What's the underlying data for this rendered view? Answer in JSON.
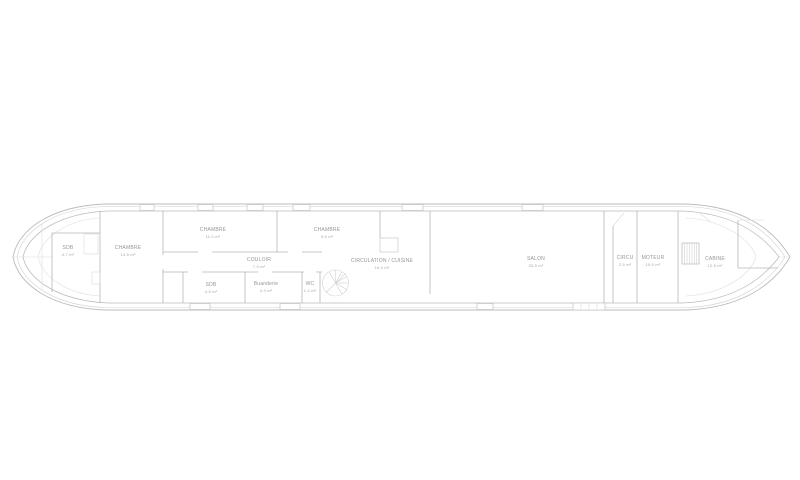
{
  "plan": {
    "title": "Barge floor plan",
    "background": "#ffffff",
    "line_color": "#b4b7ba",
    "light_line_color": "#d7d9da",
    "text_color": "#93969a"
  },
  "rooms": [
    {
      "id": "sdb-bow",
      "name": "SDB",
      "area": "4.7 m²"
    },
    {
      "id": "chambre-1",
      "name": "CHAMBRE",
      "area": "13.5 m²"
    },
    {
      "id": "chambre-2",
      "name": "CHAMBRE",
      "area": "11.0 m²"
    },
    {
      "id": "chambre-3",
      "name": "CHAMBRE",
      "area": "9.5 m²"
    },
    {
      "id": "couloir",
      "name": "COULOIR",
      "area": "7.5 m²"
    },
    {
      "id": "sdb-2",
      "name": "SDB",
      "area": "4.5 m²"
    },
    {
      "id": "buanderie",
      "name": "Buanderie",
      "area": "4.3 m²"
    },
    {
      "id": "wc",
      "name": "WC",
      "area": "1.4 m²"
    },
    {
      "id": "circulation-cuisine",
      "name": "CIRCULATION / CUISINE",
      "area": "16.0 m²"
    },
    {
      "id": "salon",
      "name": "SALON",
      "area": "33.5 m²"
    },
    {
      "id": "circu",
      "name": "CIRCU",
      "area": "2.5 m²"
    },
    {
      "id": "moteur",
      "name": "MOTEUR",
      "area": "10.0 m²"
    },
    {
      "id": "cabine",
      "name": "CABINE",
      "area": "12.5 m²"
    }
  ]
}
